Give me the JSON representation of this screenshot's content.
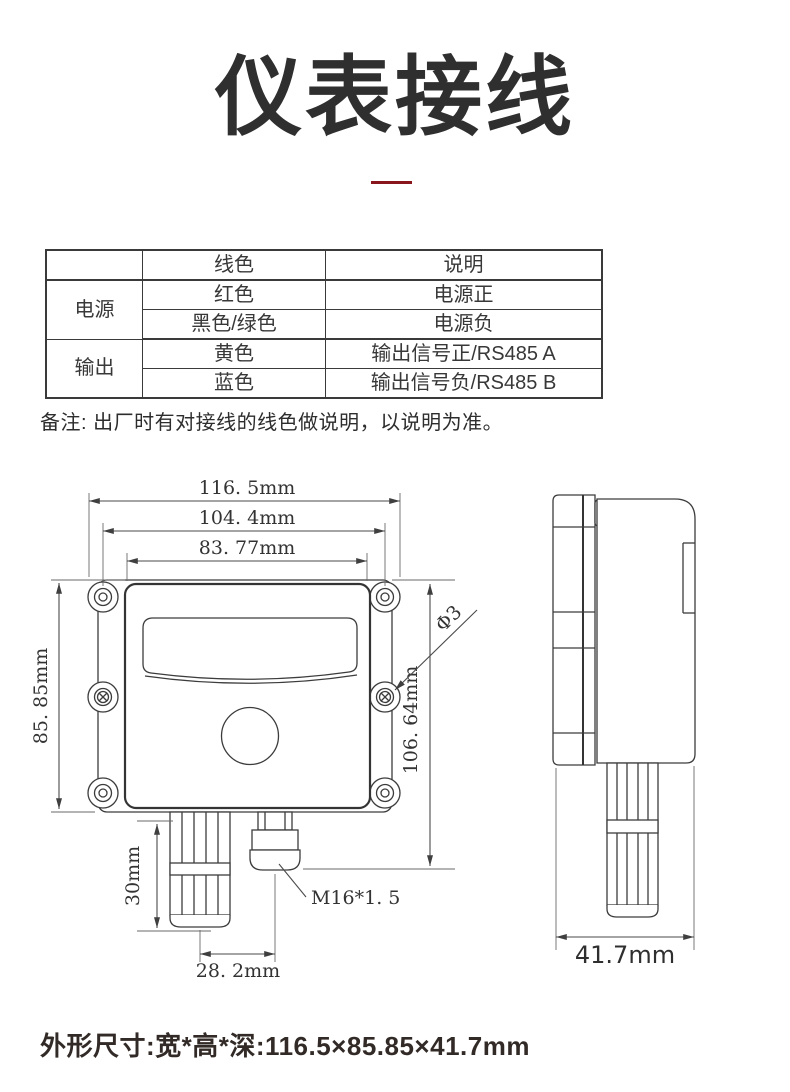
{
  "title": "仪表接线",
  "divider_color": "#8a161d",
  "wiring_table": {
    "col_headers": [
      "线色",
      "说明"
    ],
    "groups": [
      {
        "label": "电源",
        "rows": [
          [
            "红色",
            "电源正"
          ],
          [
            "黑色/绿色",
            "电源负"
          ]
        ]
      },
      {
        "label": "输出",
        "rows": [
          [
            "黄色",
            "输出信号正/RS485 A"
          ],
          [
            "蓝色",
            "输出信号负/RS485 B"
          ]
        ]
      }
    ]
  },
  "note": "备注: 出厂时有对接线的线色做说明，以说明为准。",
  "drawing": {
    "front_view": {
      "width_overall": "116. 5mm",
      "width_mount_outer": "104. 4mm",
      "width_mount_inner": "83. 77mm",
      "height_body": "85. 85mm",
      "height_overall": "106. 64mm",
      "probe_length": "30mm",
      "probe_offset": "28. 2mm",
      "mount_hole": "Φ3",
      "cable_gland": "M16*1. 5"
    },
    "side_view": {
      "depth": "41.7mm"
    }
  },
  "footer": "外形尺寸:宽*高*深:116.5×85.85×41.7mm"
}
